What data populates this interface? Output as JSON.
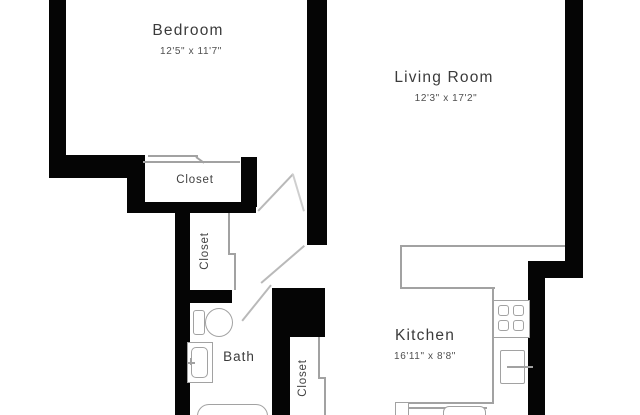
{
  "floorplan": {
    "rooms": {
      "bedroom": {
        "label": "Bedroom",
        "dimensions": "12'5\" x 11'7\""
      },
      "living_room": {
        "label": "Living Room",
        "dimensions": "12'3\" x 17'2\""
      },
      "kitchen": {
        "label": "Kitchen",
        "dimensions": "16'11\" x 8'8\""
      },
      "bath": {
        "label": "Bath"
      },
      "bedroom_closet": {
        "label": "Closet"
      },
      "hall_closet": {
        "label": "Closet"
      },
      "kitchen_closet": {
        "label": "Closet"
      }
    },
    "fixtures": [
      "toilet",
      "bathroom-sink",
      "bathtub",
      "stove-four-burners",
      "kitchen-appliance",
      "kitchen-sink",
      "door-swing",
      "closet-door"
    ],
    "colors": {
      "wall": "#050505",
      "fixture_line": "#a2a2a2",
      "text": "#3b3b3b",
      "background": "#ffffff"
    }
  }
}
